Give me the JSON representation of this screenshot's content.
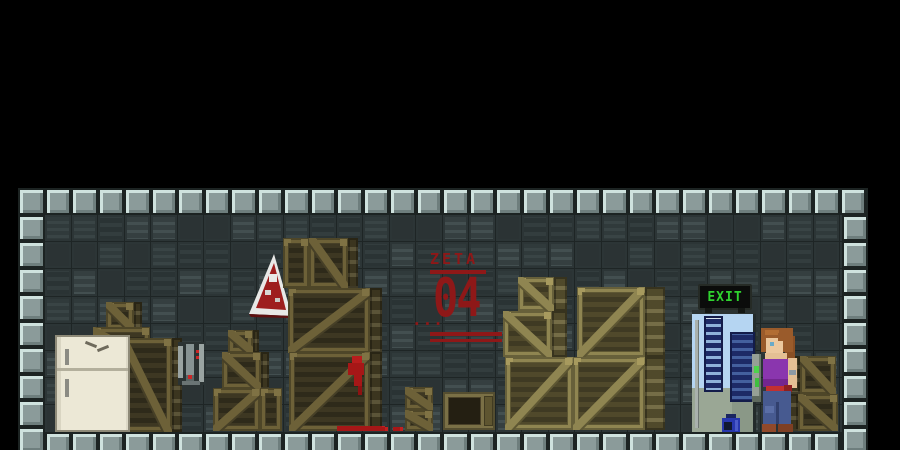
{
  "app": {
    "name": "pixel platformer level"
  },
  "level": {
    "zone_label": "ZETA",
    "zone_number": "04",
    "stencil_dots": "...",
    "exit_label": "EXIT"
  },
  "colors": {
    "background": "#000000",
    "stencil_red": "#8e1818",
    "exit_green": "#2fd32f",
    "blood_red": "#a61717",
    "frame_tile": "#8b9b9a",
    "wall_panel": "#343e3f",
    "crate_dark_frame": "#6d6138",
    "crate_khaki_frame": "#8f8551",
    "fridge_body": "#ece8d6",
    "doorway_light": "#b5d5f2",
    "rack_navy": "#1d2a66",
    "character_shirt": "#8a36ae",
    "character_jeans": "#475a90",
    "character_hair": "#9a5b2b",
    "paint_can_blue": "#2737ad"
  },
  "props": [
    {
      "name": "crate-small",
      "type": "crate",
      "pal": "dark",
      "x": 88,
      "y": 114,
      "w": 36,
      "h": 28,
      "diag": "down",
      "side": 8
    },
    {
      "name": "crate-medium",
      "type": "crate",
      "pal": "dark",
      "x": 75,
      "y": 139,
      "w": 57,
      "h": 35,
      "diag": "down",
      "side": 0
    },
    {
      "name": "crate-tall",
      "type": "crate",
      "pal": "dark",
      "x": 102,
      "y": 150,
      "w": 62,
      "h": 94,
      "diag": "down",
      "side": 10
    },
    {
      "name": "wall-device",
      "type": "device",
      "x": 160,
      "y": 154,
      "w": 26,
      "h": 43
    },
    {
      "name": "crate-small",
      "type": "crate",
      "pal": "dark",
      "x": 210,
      "y": 142,
      "w": 31,
      "h": 23,
      "diag": "down",
      "side": 6
    },
    {
      "name": "crate-medium",
      "type": "crate",
      "pal": "dark",
      "x": 204,
      "y": 164,
      "w": 47,
      "h": 37,
      "diag": "down",
      "side": 8
    },
    {
      "name": "crate-medium",
      "type": "crate",
      "pal": "dark",
      "x": 195,
      "y": 200,
      "w": 47,
      "h": 43,
      "diag": "up",
      "side": 0
    },
    {
      "name": "crate-narrow",
      "type": "crate",
      "pal": "dark",
      "x": 242,
      "y": 200,
      "w": 22,
      "h": 43,
      "diag": "none",
      "side": 0
    },
    {
      "name": "hazard-sign",
      "type": "sign",
      "x": 231,
      "y": 66,
      "w": 44,
      "h": 64
    },
    {
      "name": "crate-narrow",
      "type": "crate",
      "pal": "dark",
      "x": 265,
      "y": 50,
      "w": 26,
      "h": 50,
      "diag": "none",
      "side": 0
    },
    {
      "name": "crate-medium",
      "type": "crate",
      "pal": "dark",
      "x": 291,
      "y": 50,
      "w": 49,
      "h": 50,
      "diag": "down",
      "side": 10
    },
    {
      "name": "crate-large",
      "type": "crate",
      "pal": "dark",
      "x": 270,
      "y": 100,
      "w": 94,
      "h": 65,
      "diag": "up",
      "side": 12
    },
    {
      "name": "crate-large",
      "type": "crate",
      "pal": "dark",
      "x": 271,
      "y": 164,
      "w": 93,
      "h": 79,
      "diag": "up",
      "side": 12
    },
    {
      "name": "blood-splatter",
      "type": "blood",
      "x": 328,
      "y": 168,
      "w": 24,
      "h": 40
    },
    {
      "name": "crate-small",
      "type": "crate",
      "pal": "dark",
      "x": 387,
      "y": 199,
      "w": 28,
      "h": 23,
      "diag": "down",
      "side": 0
    },
    {
      "name": "crate-small",
      "type": "crate",
      "pal": "dark",
      "x": 387,
      "y": 222,
      "w": 28,
      "h": 21,
      "diag": "down",
      "side": 0
    },
    {
      "name": "crate-open",
      "type": "opencrate",
      "x": 425,
      "y": 204,
      "w": 52,
      "h": 38
    },
    {
      "name": "blood-floor",
      "type": "bloodline",
      "x": 319,
      "y": 238,
      "w": 48,
      "h": 5
    },
    {
      "name": "blood-floor",
      "type": "bloodline",
      "x": 362,
      "y": 239,
      "w": 8,
      "h": 4
    },
    {
      "name": "blood-floor",
      "type": "bloodline",
      "x": 375,
      "y": 239,
      "w": 10,
      "h": 4
    },
    {
      "name": "crate-small",
      "type": "crate",
      "pal": "khaki",
      "x": 500,
      "y": 89,
      "w": 49,
      "h": 34,
      "diag": "down",
      "side": 13
    },
    {
      "name": "crate-medium",
      "type": "crate",
      "pal": "khaki",
      "x": 485,
      "y": 123,
      "w": 64,
      "h": 46,
      "diag": "down",
      "side": 15
    },
    {
      "name": "crate-large",
      "type": "crate",
      "pal": "khaki",
      "x": 559,
      "y": 99,
      "w": 88,
      "h": 70,
      "diag": "up",
      "side": 20
    },
    {
      "name": "crate-large",
      "type": "crate",
      "pal": "khaki",
      "x": 487,
      "y": 169,
      "w": 68,
      "h": 73,
      "diag": "up",
      "side": 0
    },
    {
      "name": "crate-large",
      "type": "crate",
      "pal": "khaki",
      "x": 555,
      "y": 169,
      "w": 92,
      "h": 73,
      "diag": "up",
      "side": 20
    },
    {
      "name": "crate-small",
      "type": "crate",
      "pal": "dark",
      "x": 770,
      "y": 168,
      "w": 48,
      "h": 38,
      "diag": "down",
      "side": 12,
      "sideLeft": true
    },
    {
      "name": "crate-medium",
      "type": "crate",
      "pal": "dark",
      "x": 768,
      "y": 206,
      "w": 52,
      "h": 37,
      "diag": "down",
      "side": 12,
      "sideLeft": true
    },
    {
      "name": "paint-can",
      "type": "can",
      "x": 704,
      "y": 226,
      "w": 20,
      "h": 20
    }
  ]
}
